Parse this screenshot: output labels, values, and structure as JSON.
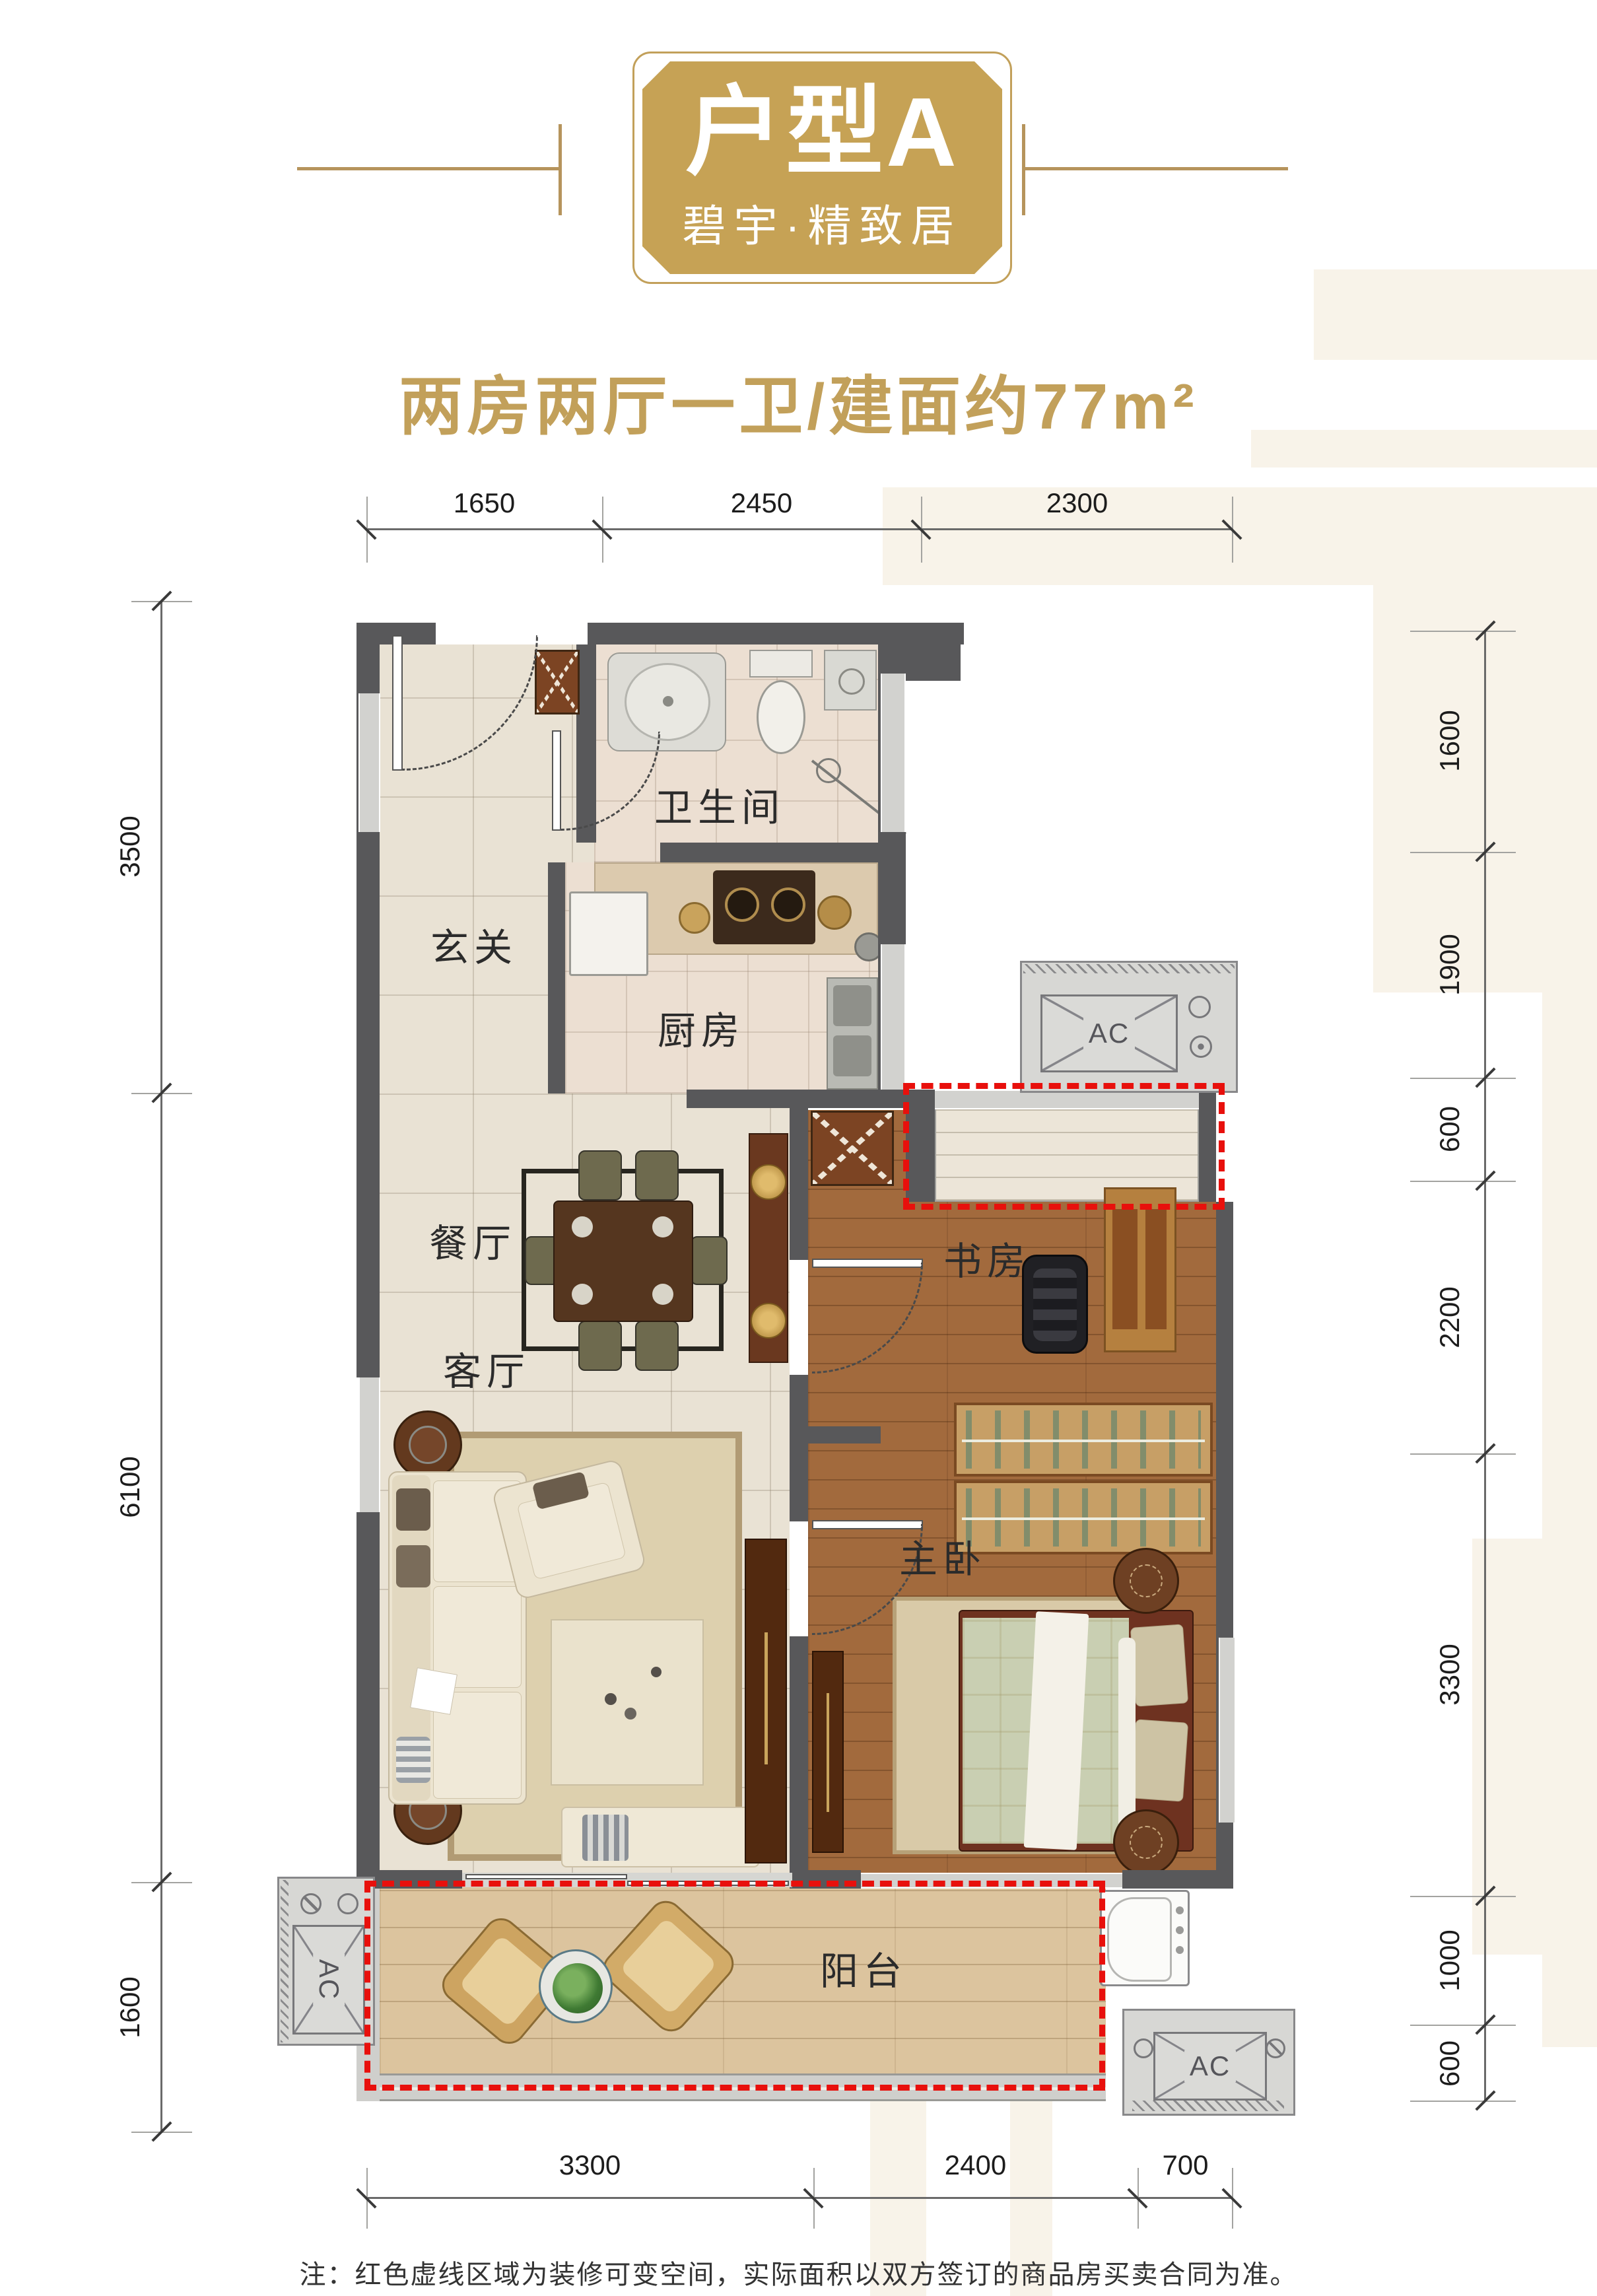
{
  "header": {
    "badge_title": "户型A",
    "badge_subtitle": "碧宇·精致居",
    "tagline": "两房两厅一卫/建面约77m²"
  },
  "dimensions": {
    "top": [
      "1650",
      "2450",
      "2300"
    ],
    "left": [
      "3500",
      "6100",
      "1600"
    ],
    "right": [
      "1600",
      "1900",
      "600",
      "2200",
      "3300",
      "1000",
      "600"
    ],
    "bottom": [
      "3300",
      "2400",
      "700"
    ]
  },
  "rooms": {
    "foyer": "玄关",
    "bathroom": "卫生间",
    "kitchen": "厨房",
    "dining": "餐厅",
    "living": "客厅",
    "study": "书房",
    "master": "主卧",
    "balcony": "阳台"
  },
  "labels": {
    "ac": "AC"
  },
  "footer": {
    "note": "注：红色虚线区域为装修可变空间，实际面积以双方签订的商品房买卖合同为准。"
  },
  "colors": {
    "gold": "#c2a05a",
    "red": "#e8100c",
    "wall": "#58585a",
    "cream": "#f8f3e9"
  }
}
